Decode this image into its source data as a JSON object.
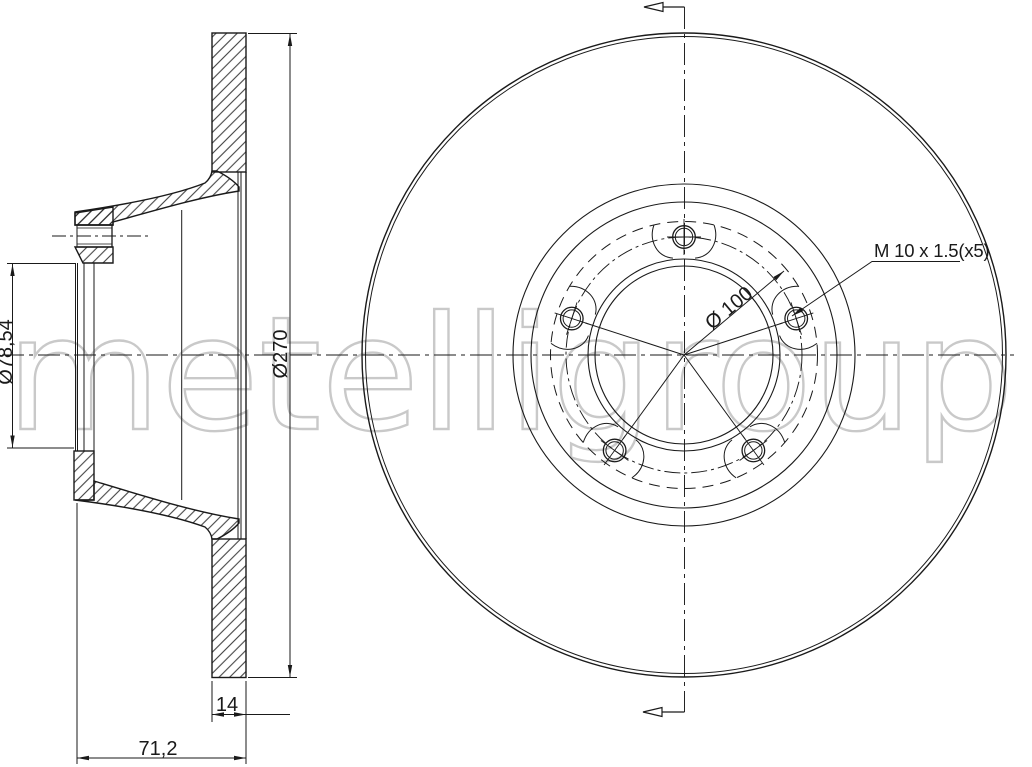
{
  "drawing": {
    "title": "brake-disc-technical-drawing",
    "line_color": "#1a1a1a",
    "background": "#ffffff"
  },
  "watermark": {
    "text": "metelligroup",
    "color": "#c9c9c9"
  },
  "section_view": {
    "bore_diameter_label": "Ø78,54",
    "outer_diameter_label": "Ø270",
    "thickness_label": "14",
    "overall_height_label": "71,2"
  },
  "front_view": {
    "bolt_circle_label": "Ø 100",
    "thread_label": "M 10 x 1.5(x5)",
    "bolt_hole_count": 5
  }
}
